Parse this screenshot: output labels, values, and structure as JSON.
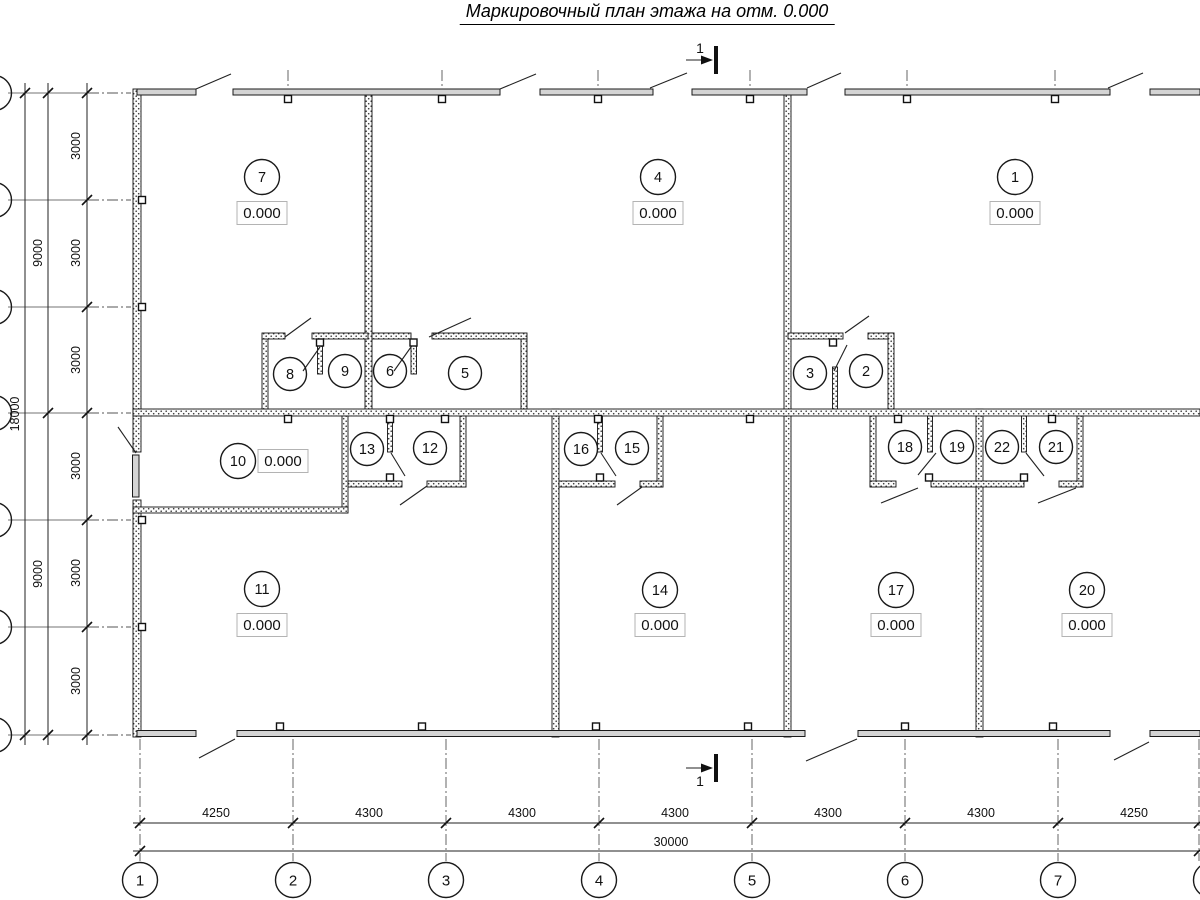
{
  "title": "Маркировочный план этажа на отм. 0.000",
  "section": {
    "label": "1"
  },
  "rooms": [
    {
      "n": "7",
      "elev": "0.000"
    },
    {
      "n": "4",
      "elev": "0.000"
    },
    {
      "n": "1",
      "elev": "0.000"
    },
    {
      "n": "8"
    },
    {
      "n": "9"
    },
    {
      "n": "6"
    },
    {
      "n": "5"
    },
    {
      "n": "3"
    },
    {
      "n": "2"
    },
    {
      "n": "10",
      "elev": "0.000"
    },
    {
      "n": "13"
    },
    {
      "n": "12"
    },
    {
      "n": "16"
    },
    {
      "n": "15"
    },
    {
      "n": "18"
    },
    {
      "n": "19"
    },
    {
      "n": "22"
    },
    {
      "n": "21"
    },
    {
      "n": "11",
      "elev": "0.000"
    },
    {
      "n": "14",
      "elev": "0.000"
    },
    {
      "n": "17",
      "elev": "0.000"
    },
    {
      "n": "20",
      "elev": "0.000"
    }
  ],
  "axes": {
    "bottom": [
      "1",
      "2",
      "3",
      "4",
      "5",
      "6",
      "7"
    ]
  },
  "dims": {
    "bottom": [
      "4250",
      "4300",
      "4300",
      "4300",
      "4300",
      "4300",
      "4250"
    ],
    "total": "30000",
    "left_inner": [
      "3000",
      "3000",
      "3000",
      "3000",
      "3000",
      "3000"
    ],
    "left_mid": [
      "9000",
      "9000"
    ],
    "left_outer": "18000"
  },
  "colors": {
    "ink": "#111111",
    "window_fill": "#d4d4d4"
  }
}
